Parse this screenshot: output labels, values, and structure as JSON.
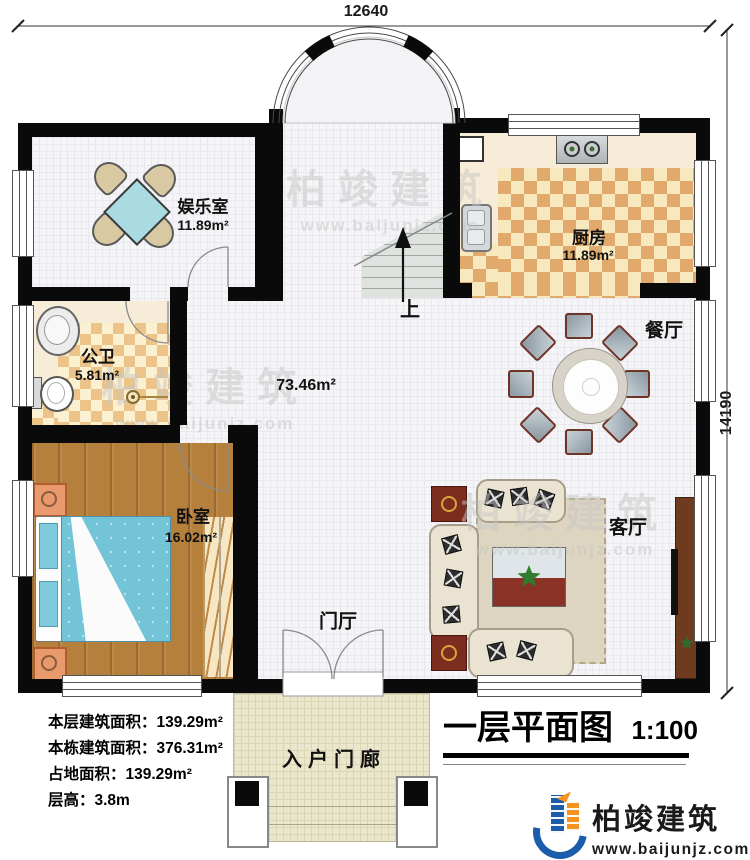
{
  "dimensions": {
    "width_label": "12640",
    "height_label": "14190"
  },
  "rooms": {
    "entertainment": {
      "name": "娱乐室",
      "area": "11.89m²"
    },
    "kitchen": {
      "name": "厨房",
      "area": "11.89m²"
    },
    "bathroom": {
      "name": "公卫",
      "area": "5.81m²"
    },
    "dining": {
      "name": "餐厅"
    },
    "living": {
      "name": "客厅"
    },
    "bedroom": {
      "name": "卧室",
      "area": "16.02m²"
    },
    "foyer": {
      "name": "门厅"
    },
    "porch": {
      "name": "入户门廊"
    },
    "hall": {
      "area": "73.46m²"
    },
    "stairs": {
      "direction": "上"
    }
  },
  "info": {
    "lines": [
      "本层建筑面积：139.29m²",
      "本栋建筑面积：376.31m²",
      "占地面积：139.29m²",
      "层高：3.8m"
    ]
  },
  "title": {
    "text": "一层平面图",
    "scale": "1:100"
  },
  "brand": {
    "name": "柏竣建筑",
    "website": "www.baijunjz.com"
  },
  "watermark": {
    "name": "柏竣建筑",
    "website": "www.baijunjz.com"
  },
  "colors": {
    "wall": "#0a0a0a",
    "brand_blue": "#1a5dab",
    "brand_orange": "#f7941d"
  }
}
